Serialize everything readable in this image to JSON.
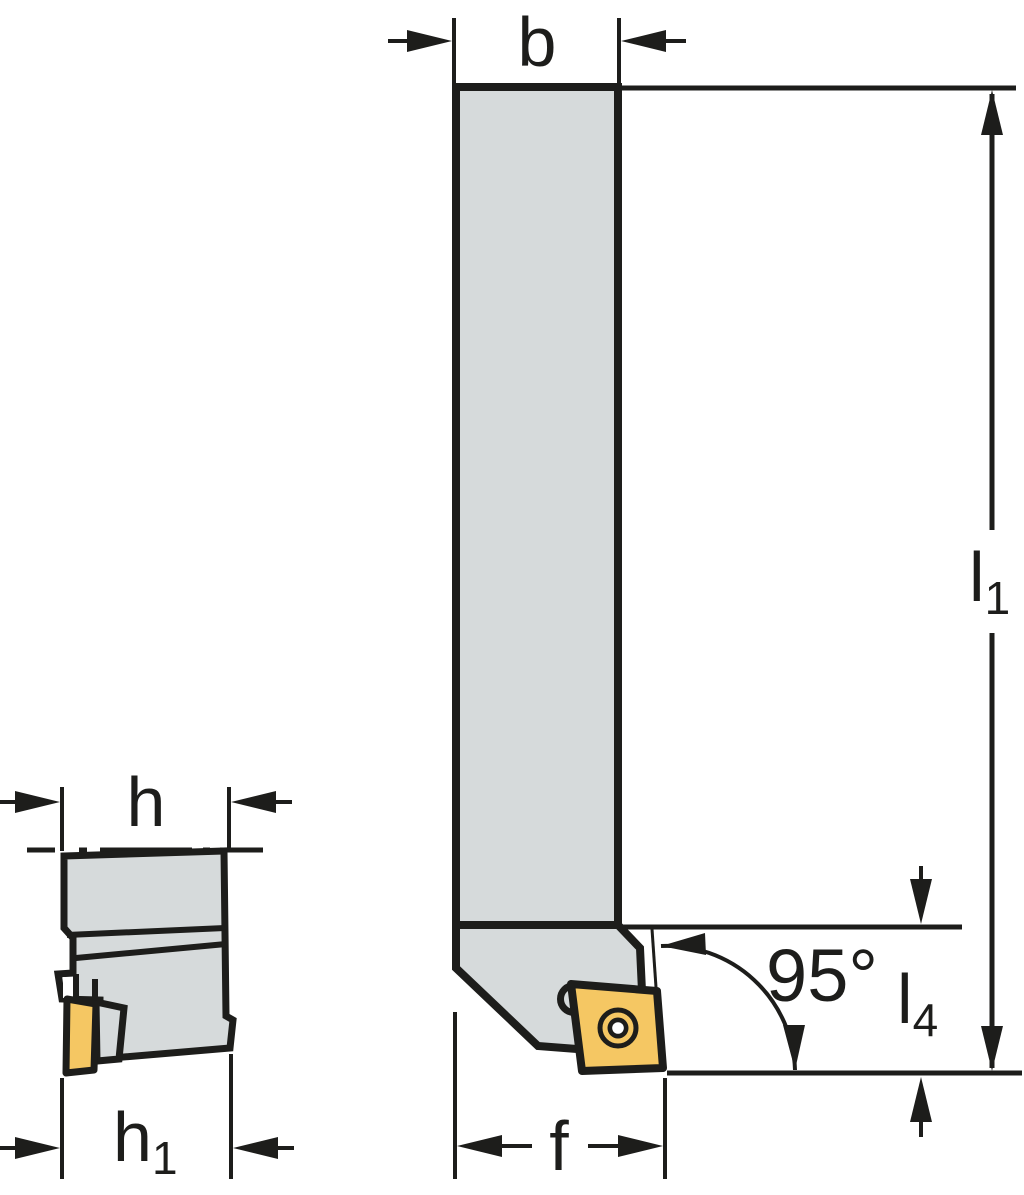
{
  "colors": {
    "body_fill": "#d6dadb",
    "insert_fill": "#f5c763",
    "line": "#1d1d1b",
    "background": "#ffffff"
  },
  "front_view": {
    "dim_b": "b",
    "dim_l1_main": "l",
    "dim_l1_sub": "1",
    "dim_l4_main": "l",
    "dim_l4_sub": "4",
    "dim_f": "f",
    "angle": "95°"
  },
  "side_view": {
    "dim_h": "h",
    "dim_h1_main": "h",
    "dim_h1_sub": "1"
  }
}
